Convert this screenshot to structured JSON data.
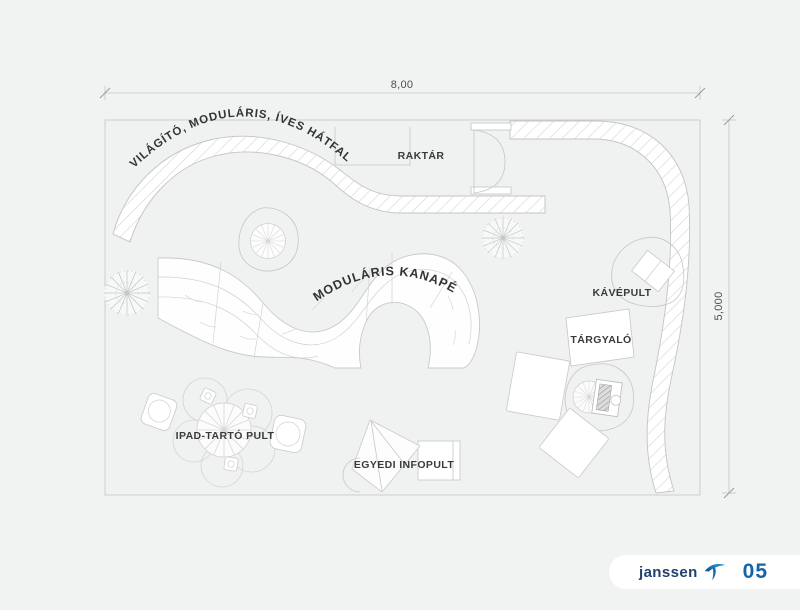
{
  "sheet": {
    "dimensions": {
      "width": "8,00",
      "height": "5,000"
    },
    "areas": {
      "backwall_label": "VILÁGÍTÓ, MODULÁRIS, ÍVES HÁTFAL",
      "storage_label": "RAKTÁR",
      "sofa_label": "MODULÁRIS KANAPÉ",
      "coffee_counter_label": "KÁVÉPULT",
      "meeting_label": "TÁRGYALÓ",
      "ipad_stand_label": "IPAD-TARTÓ PULT",
      "info_desk_label": "EGYEDI INFOPULT"
    }
  },
  "footer": {
    "brand": "janssen",
    "page_number": "05"
  },
  "colors": {
    "background": "#f1f2f2",
    "drawing_line": "#c6c6c6",
    "label_text": "#3a3a3a",
    "brand_navy": "#21406f",
    "brand_blue": "#1c82c6",
    "page_number_blue": "#1565a9"
  }
}
